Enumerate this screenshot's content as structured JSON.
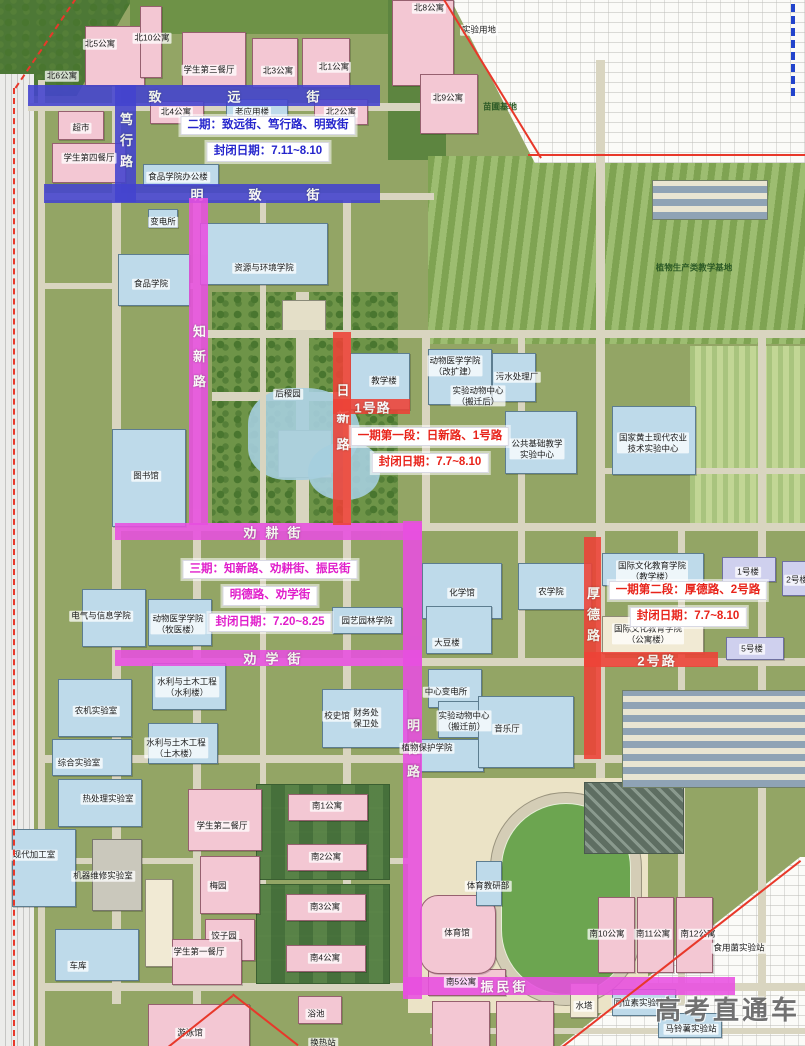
{
  "map": {
    "colors": {
      "p1": "#ee4237",
      "p2": "#4343cf",
      "p3": "#e84fe0"
    },
    "text_colors": {
      "p1": "#e8231a",
      "p2": "#2525cc",
      "p3": "#e01ecb"
    },
    "roads": [
      {
        "id": "zhiyuan",
        "name": "致远街",
        "phase": "p2",
        "x": 28,
        "y": 85,
        "w": 352,
        "h": 21,
        "label": "致远街",
        "lcx": 234,
        "ls": 66
      },
      {
        "id": "duxing",
        "name": "笃行路",
        "phase": "p2",
        "x": 115,
        "y": 85,
        "w": 21,
        "h": 117,
        "v": true,
        "label": "笃行路",
        "lcy": 140,
        "ls": 8
      },
      {
        "id": "mingzhi",
        "name": "明致街",
        "phase": "p2",
        "x": 44,
        "y": 184,
        "w": 336,
        "h": 19,
        "label": "明致街",
        "lcx": 255,
        "ls": 45
      },
      {
        "id": "zhixin",
        "name": "知新路",
        "phase": "p3",
        "x": 189,
        "y": 198,
        "w": 19,
        "h": 327,
        "v": true,
        "label": "知新路",
        "lcy": 356,
        "ls": 12
      },
      {
        "id": "quangeng",
        "name": "劝耕街",
        "phase": "p3",
        "x": 115,
        "y": 523,
        "w": 307,
        "h": 17,
        "label": "劝耕街",
        "lcx": 272,
        "ls": 9
      },
      {
        "id": "quanxue",
        "name": "劝学街",
        "phase": "p3",
        "x": 115,
        "y": 650,
        "w": 307,
        "h": 16,
        "label": "劝学街",
        "lcx": 272,
        "ls": 9
      },
      {
        "id": "mingde",
        "name": "明德路",
        "phase": "p3",
        "x": 403,
        "y": 521,
        "w": 19,
        "h": 478,
        "v": true,
        "label": "明德路",
        "lcy": 748,
        "ls": 10
      },
      {
        "id": "zhenmin",
        "name": "振民街",
        "phase": "p3",
        "x": 403,
        "y": 977,
        "w": 332,
        "h": 18,
        "label": "振民街",
        "lcx": 503,
        "ls": 3
      },
      {
        "id": "rixin",
        "name": "日新路",
        "phase": "p1",
        "x": 333,
        "y": 332,
        "w": 18,
        "h": 193,
        "v": true,
        "label": "日新路",
        "lcy": 417,
        "ls": 14
      },
      {
        "id": "road1",
        "name": "1号路",
        "phase": "p1",
        "x": 333,
        "y": 399,
        "w": 77,
        "h": 15,
        "label": "1号路",
        "lcx": 372,
        "ls": 1
      },
      {
        "id": "houde",
        "name": "厚德路",
        "phase": "p1",
        "x": 584,
        "y": 537,
        "w": 17,
        "h": 222,
        "v": true,
        "label": "厚德路",
        "lcy": 614,
        "ls": 8
      },
      {
        "id": "road2",
        "name": "2号路",
        "phase": "p1",
        "x": 584,
        "y": 652,
        "w": 134,
        "h": 15,
        "label": "2号路",
        "lcx": 656,
        "ls": 2
      }
    ],
    "closures": [
      {
        "id": "phase2",
        "phase": "p2",
        "cx": 268,
        "y": 116,
        "lines": [
          "二期：致远街、笃行路、明致街",
          "封闭日期：7.11~8.10"
        ]
      },
      {
        "id": "phase1a",
        "phase": "p1",
        "cx": 430,
        "y": 427,
        "lines": [
          "一期第一段：日新路、1号路",
          "封闭日期：7.7~8.10"
        ]
      },
      {
        "id": "phase3",
        "phase": "p3",
        "cx": 270,
        "y": 560,
        "lines": [
          "三期：知新路、劝耕街、振民街",
          "明德路、劝学街",
          "封闭日期：7.20~8.25"
        ]
      },
      {
        "id": "phase1b",
        "phase": "p1",
        "cx": 688,
        "y": 581,
        "lines": [
          "一期第二段：厚德路、2号路",
          "封闭日期：7.7~8.10"
        ]
      }
    ],
    "buildings": [
      {
        "label": "北5公寓",
        "cx": 100,
        "cy": 44
      },
      {
        "label": "北6公寓",
        "cx": 62,
        "cy": 76
      },
      {
        "label": "北10公寓",
        "cx": 152,
        "cy": 38
      },
      {
        "label": "学生第三餐厅",
        "cx": 209,
        "cy": 70
      },
      {
        "label": "北3公寓",
        "cx": 278,
        "cy": 71
      },
      {
        "label": "北1公寓",
        "cx": 334,
        "cy": 67
      },
      {
        "label": "北8公寓",
        "cx": 429,
        "cy": 8
      },
      {
        "label": "实验用地",
        "cx": 479,
        "cy": 30
      },
      {
        "label": "北9公寓",
        "cx": 448,
        "cy": 98
      },
      {
        "label": "北4公寓",
        "cx": 176,
        "cy": 112
      },
      {
        "label": "老应用楼",
        "cx": 252,
        "cy": 112
      },
      {
        "label": "北2公寓",
        "cx": 341,
        "cy": 112
      },
      {
        "label": "超市",
        "cx": 81,
        "cy": 128
      },
      {
        "label": "学生第四餐厅",
        "cx": 89,
        "cy": 158
      },
      {
        "label": "食品学院办公楼",
        "cx": 178,
        "cy": 177
      },
      {
        "label": "苗圃基地",
        "cx": 500,
        "cy": 107,
        "green": true
      },
      {
        "label": "变电所",
        "cx": 163,
        "cy": 222
      },
      {
        "label": "资源与环境学院",
        "cx": 264,
        "cy": 268
      },
      {
        "label": "食品学院",
        "cx": 151,
        "cy": 284
      },
      {
        "label": "后稷园",
        "cx": 288,
        "cy": 394
      },
      {
        "label": "图书馆",
        "cx": 146,
        "cy": 476
      },
      {
        "label": "教学楼",
        "cx": 384,
        "cy": 381
      },
      {
        "lines": [
          "动物医学学院",
          "（改扩建）"
        ],
        "cx": 455,
        "cy": 366
      },
      {
        "lines": [
          "实验动物中心",
          "（搬迁后）"
        ],
        "cx": 478,
        "cy": 396
      },
      {
        "label": "污水处理厂",
        "cx": 517,
        "cy": 377
      },
      {
        "lines": [
          "公共基础教学",
          "实验中心"
        ],
        "cx": 537,
        "cy": 449
      },
      {
        "lines": [
          "国家黄土现代农业",
          "技术实验中心"
        ],
        "cx": 653,
        "cy": 443
      },
      {
        "label": "植物生产类教学基地",
        "cx": 694,
        "cy": 268,
        "green": true
      },
      {
        "lines": [
          "国际文化教育学院",
          "（教学楼）"
        ],
        "cx": 652,
        "cy": 571
      },
      {
        "lines": [
          "国际文化教育学院",
          "（公寓楼）"
        ],
        "cx": 648,
        "cy": 634
      },
      {
        "label": "1号楼",
        "cx": 748,
        "cy": 572
      },
      {
        "label": "2号楼",
        "cx": 797,
        "cy": 580
      },
      {
        "label": "5号楼",
        "cx": 752,
        "cy": 649
      },
      {
        "label": "化学馆",
        "cx": 462,
        "cy": 593
      },
      {
        "label": "农学院",
        "cx": 551,
        "cy": 592
      },
      {
        "label": "大豆楼",
        "cx": 447,
        "cy": 643
      },
      {
        "label": "中心变电所",
        "cx": 446,
        "cy": 692
      },
      {
        "label": "校史馆",
        "cx": 337,
        "cy": 716
      },
      {
        "lines": [
          "财务处",
          "保卫处"
        ],
        "cx": 366,
        "cy": 718
      },
      {
        "lines": [
          "实验动物中心",
          "（搬迁前）"
        ],
        "cx": 464,
        "cy": 721
      },
      {
        "label": "植物保护学院",
        "cx": 427,
        "cy": 748
      },
      {
        "label": "音乐厅",
        "cx": 507,
        "cy": 729
      },
      {
        "label": "电气与信息学院",
        "cx": 101,
        "cy": 616
      },
      {
        "lines": [
          "动物医学学院",
          "（牧医楼）"
        ],
        "cx": 178,
        "cy": 624
      },
      {
        "label": "园艺园林学院",
        "cx": 367,
        "cy": 621
      },
      {
        "lines": [
          "水利与土木工程",
          "（水利楼）"
        ],
        "cx": 187,
        "cy": 687
      },
      {
        "lines": [
          "水利与土木工程",
          "（土木楼）"
        ],
        "cx": 176,
        "cy": 748
      },
      {
        "label": "农机实验室",
        "cx": 96,
        "cy": 711
      },
      {
        "label": "综合实验室",
        "cx": 79,
        "cy": 763
      },
      {
        "label": "热处理实验室",
        "cx": 108,
        "cy": 799
      },
      {
        "label": "现代加工室",
        "cx": 34,
        "cy": 855
      },
      {
        "label": "机器维修实验室",
        "cx": 103,
        "cy": 876
      },
      {
        "label": "车库",
        "cx": 78,
        "cy": 966
      },
      {
        "label": "学生第二餐厅",
        "cx": 222,
        "cy": 826
      },
      {
        "label": "梅园",
        "cx": 218,
        "cy": 886
      },
      {
        "label": "饺子园",
        "cx": 224,
        "cy": 936
      },
      {
        "label": "学生第一餐厅",
        "cx": 199,
        "cy": 952
      },
      {
        "label": "游泳馆",
        "cx": 190,
        "cy": 1033
      },
      {
        "label": "浴池",
        "cx": 316,
        "cy": 1014
      },
      {
        "label": "换热站",
        "cx": 323,
        "cy": 1043
      },
      {
        "label": "南1公寓",
        "cx": 327,
        "cy": 806
      },
      {
        "label": "南2公寓",
        "cx": 326,
        "cy": 857
      },
      {
        "label": "南3公寓",
        "cx": 325,
        "cy": 907
      },
      {
        "label": "南4公寓",
        "cx": 325,
        "cy": 958
      },
      {
        "label": "南5公寓",
        "cx": 461,
        "cy": 982
      },
      {
        "label": "体育教研部",
        "cx": 488,
        "cy": 886
      },
      {
        "label": "体育馆",
        "cx": 457,
        "cy": 933
      },
      {
        "label": "南10公寓",
        "cx": 607,
        "cy": 934
      },
      {
        "label": "南11公寓",
        "cx": 653,
        "cy": 934
      },
      {
        "label": "南12公寓",
        "cx": 698,
        "cy": 934
      },
      {
        "label": "食用菌实验站",
        "cx": 739,
        "cy": 948
      },
      {
        "label": "同位素实验楼",
        "cx": 639,
        "cy": 1003
      },
      {
        "label": "马铃薯实验站",
        "cx": 691,
        "cy": 1029
      },
      {
        "label": "水塔",
        "cx": 584,
        "cy": 1006
      }
    ],
    "watermark": "高考直通车"
  }
}
